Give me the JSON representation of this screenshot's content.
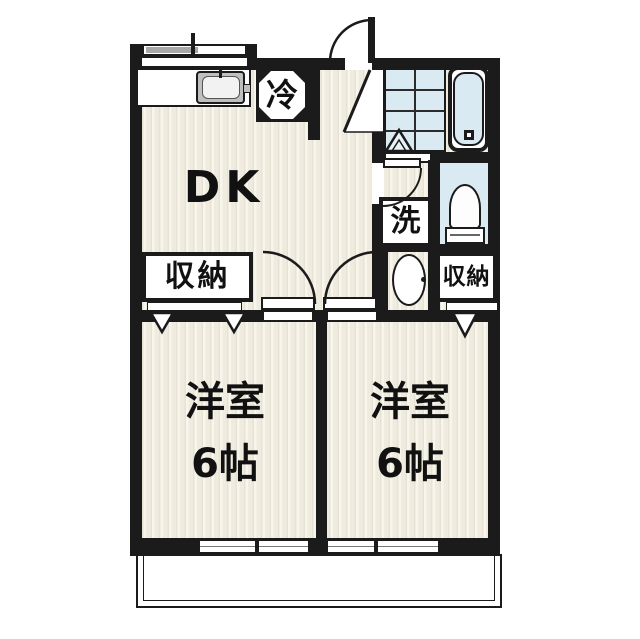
{
  "title": "apartment-floor-plan",
  "colors": {
    "wall": "#1b1b1b",
    "floor_cream": "#efecdf",
    "wet_blue": "#d9eaf3",
    "text": "#111111"
  },
  "rooms": {
    "dk": {
      "label": "DK"
    },
    "western1": {
      "label": "洋室",
      "size": "6帖"
    },
    "western2": {
      "label": "洋室",
      "size": "6帖"
    }
  },
  "storage": {
    "left": {
      "label": "収納"
    },
    "right": {
      "label": "収納"
    }
  },
  "fixtures": {
    "refrigerator": {
      "label": "冷"
    },
    "washing_machine": {
      "label": "洗"
    }
  }
}
